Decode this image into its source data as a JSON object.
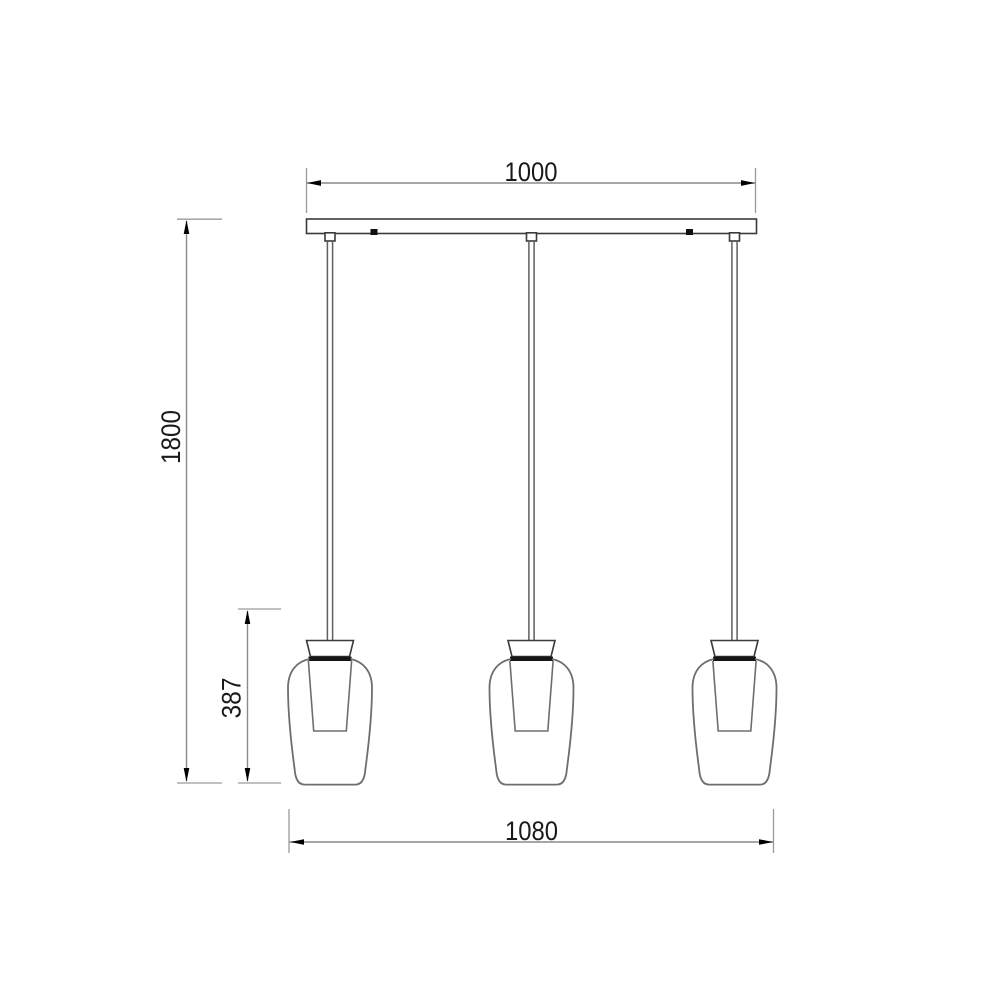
{
  "page": {
    "background_color": "#ffffff",
    "description": "Technical dimension drawing, front elevation of a 3-light linear pendant lamp"
  },
  "fixture": {
    "pendant_count": 3
  },
  "dimensions": {
    "canopy_width": {
      "label": "1000",
      "orientation": "horizontal",
      "position": "top"
    },
    "drop_height": {
      "label": "1800",
      "orientation": "vertical",
      "position": "left-outer"
    },
    "shade_height": {
      "label": "387",
      "orientation": "vertical",
      "position": "left-inner"
    },
    "overall_width": {
      "label": "1080",
      "orientation": "horizontal",
      "position": "bottom"
    }
  },
  "colors": {
    "outline": "#3a3a3a",
    "glass_outline": "#6e6e6e",
    "dimension_line": "#8a8a8a",
    "extension_line": "#9a9a9a",
    "arrow": "#000000",
    "label_text": "#1a1a1a",
    "socket_band": "#161616"
  }
}
